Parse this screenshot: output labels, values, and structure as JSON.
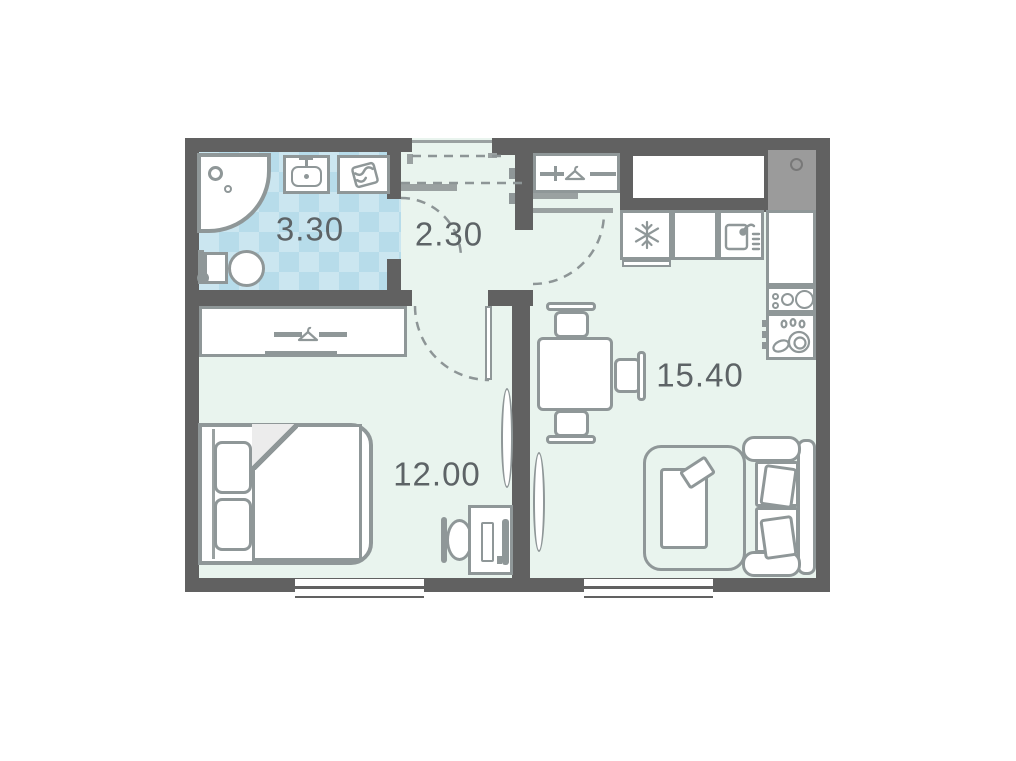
{
  "rooms": {
    "bathroom": {
      "area": "3.30"
    },
    "hallway": {
      "area": "2.30"
    },
    "kitchen_living": {
      "area": "15.40"
    },
    "bedroom": {
      "area": "12.00"
    }
  },
  "colors": {
    "wall": "#616161",
    "floor": "#e9f4ee",
    "bathFloorA": "#cbe6f0",
    "bathFloorB": "#b7dcea",
    "outline": "#8f9798",
    "outlineSoft": "#9aa1a1",
    "dash": "#8d9596",
    "labelText": "#5d6366",
    "ventFill": "#9b9b9b",
    "fixtureFill": "#ffffff"
  },
  "icons": {
    "shower": "shower-head-icon",
    "bathroom_sink": "wash-basin-icon",
    "washing_machine": "laundry-basket-icon",
    "toilet": "toilet-icon",
    "coat_rack": "clothes-hanger-icon",
    "wardrobe": "clothes-hanger-icon",
    "fridge": "snowflake-icon",
    "kitchen_sink": "sink-faucet-icon",
    "stove": "burners-icon",
    "dishwasher": "dishes-icon",
    "tv": "tv-icon",
    "desk": "computer-icon"
  }
}
